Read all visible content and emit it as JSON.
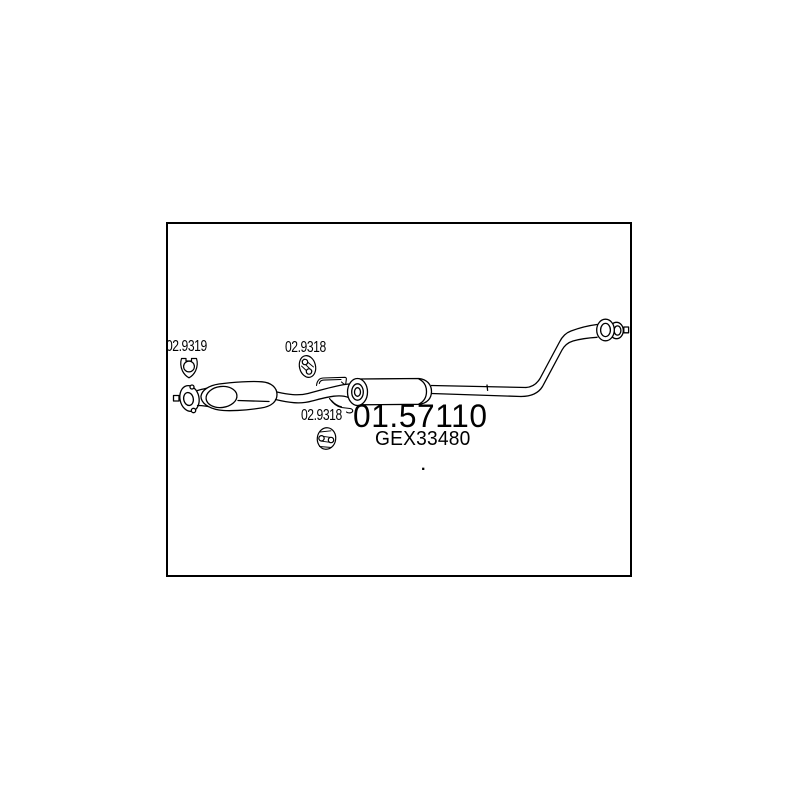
{
  "page": {
    "background_color": "#ffffff",
    "line_color": "#000000",
    "text_color": "#000000"
  },
  "diagram": {
    "type": "exhaust-system-part-drawing",
    "part_labels": {
      "flange_gasket": "02.9319",
      "hanger_front": "02.9318",
      "hanger_rear": "02.9318",
      "main_part_number": "01.57110",
      "oem_reference": "GEX33480",
      "separator_dot": "."
    },
    "icons": [
      {
        "name": "flange-gasket-icon",
        "for_label": "02.9319"
      },
      {
        "name": "rubber-hanger-icon",
        "for_label": "02.9318"
      },
      {
        "name": "rubber-hanger-icon",
        "for_label": "02.9318"
      }
    ]
  }
}
